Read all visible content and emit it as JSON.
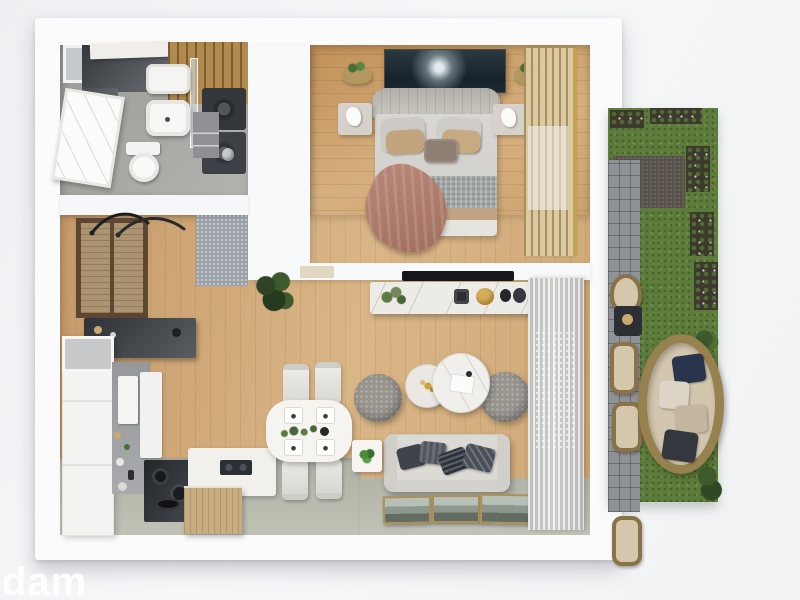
{
  "scene": {
    "type": "3d-floor-plan-render",
    "view": "top-down",
    "subject": "one-bedroom apartment with garden terrace"
  },
  "watermark": {
    "text": "dam"
  },
  "palette": {
    "background": "#f3f4f6",
    "wall": "#fbfbfc",
    "wall_shadow": "#dcdee2",
    "wood_floor": "#cfa876",
    "wood_floor_bedroom": "#c89c6a",
    "tile_floor": "#b5b7ab",
    "bathroom_floor": "#a8a9a5",
    "entry_mat": "#9aa0a6",
    "grass": "#5d7c3b",
    "paver": "#8f9296",
    "gravel": "#57504a",
    "wicker": "#97814f",
    "outdoor_cushion": "#d2c6ae",
    "navy_pillow": "#28354c",
    "sofa": "#dcdad4",
    "pouf": "#98958f",
    "marble": "#edebe6",
    "gold": "#c2a24c",
    "bed_throw": "#b08073",
    "bed_pillow": "#c4ae8a",
    "dark_counter": "#33363b",
    "wood_cabinet": "#ab9372",
    "artwork": "#26343b",
    "tv": "#15171a",
    "plant_green": "#4c6c38"
  },
  "rooms": {
    "bathroom": {
      "items": [
        "vanity",
        "shelf",
        "washbasin",
        "sink",
        "wood-shower-floor",
        "glass-partition",
        "washer",
        "dryer",
        "toilet",
        "storage-cabinet",
        "trash-bin",
        "leaning-picture"
      ]
    },
    "hallway": {
      "items": [
        "wardrobe",
        "coat-hooks",
        "console-table",
        "entry-mat"
      ]
    },
    "kitchen": {
      "items": [
        "tall-cabinet",
        "backsplash",
        "wall-cabinets",
        "counter-with-cookware",
        "cooktop",
        "wood-island"
      ]
    },
    "dining": {
      "items": [
        "table",
        "chairs-x4",
        "place-settings-x4",
        "garland-centerpiece"
      ]
    },
    "living": {
      "items": [
        "sofa",
        "throw-pillows-x4",
        "coffee-tables-x2",
        "poufs-x2",
        "side-table",
        "tv",
        "media-console",
        "floor-plant",
        "leaning-art-frames-x3",
        "curtain"
      ]
    },
    "bedroom": {
      "items": [
        "double-bed",
        "headboard",
        "nightstands-x2",
        "figurine-lamps-x2",
        "wall-art",
        "wall-planters-x2",
        "window-blind",
        "sheer-curtain",
        "throw-blanket"
      ]
    },
    "garden": {
      "items": [
        "lawn",
        "gravel-patch",
        "flower-beds",
        "paver-path",
        "wicker-chairs-x4",
        "outdoor-table",
        "round-wicker-sofa",
        "bushes"
      ]
    }
  }
}
